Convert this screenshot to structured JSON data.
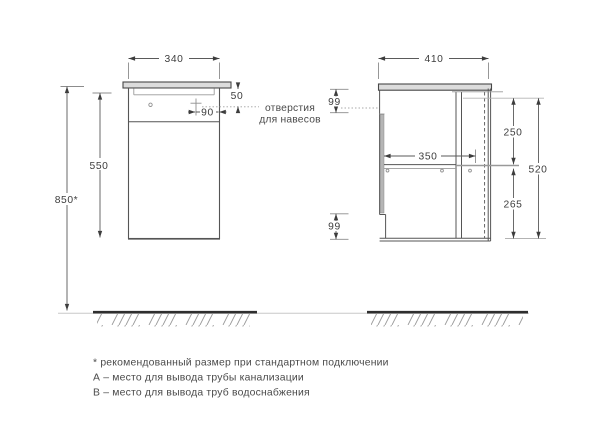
{
  "front_view": {
    "top_width": "340",
    "hanger_offset_vertical": "50",
    "hanger_offset_horizontal": "90",
    "cabinet_height": "550",
    "total_height": "850*",
    "hanger_note_line1": "отверстия",
    "hanger_note_line2": "для навесов"
  },
  "side_view": {
    "top_depth": "410",
    "top_back_gap": "99",
    "upper_section_height": "250",
    "inner_depth": "350",
    "carcass_height": "520",
    "lower_section_height": "265",
    "bottom_back_gap": "99"
  },
  "legend": {
    "note_recommended": "* рекомендованный размер при стандартном подключении",
    "note_a": "А – место для вывода трубы канализации",
    "note_b": "В – место для вывода труб водоснабжения"
  },
  "colors": {
    "line": "#4a4a4a",
    "countertop_fill": "#dcdcdc",
    "door_fill": "#b5b5b5"
  }
}
